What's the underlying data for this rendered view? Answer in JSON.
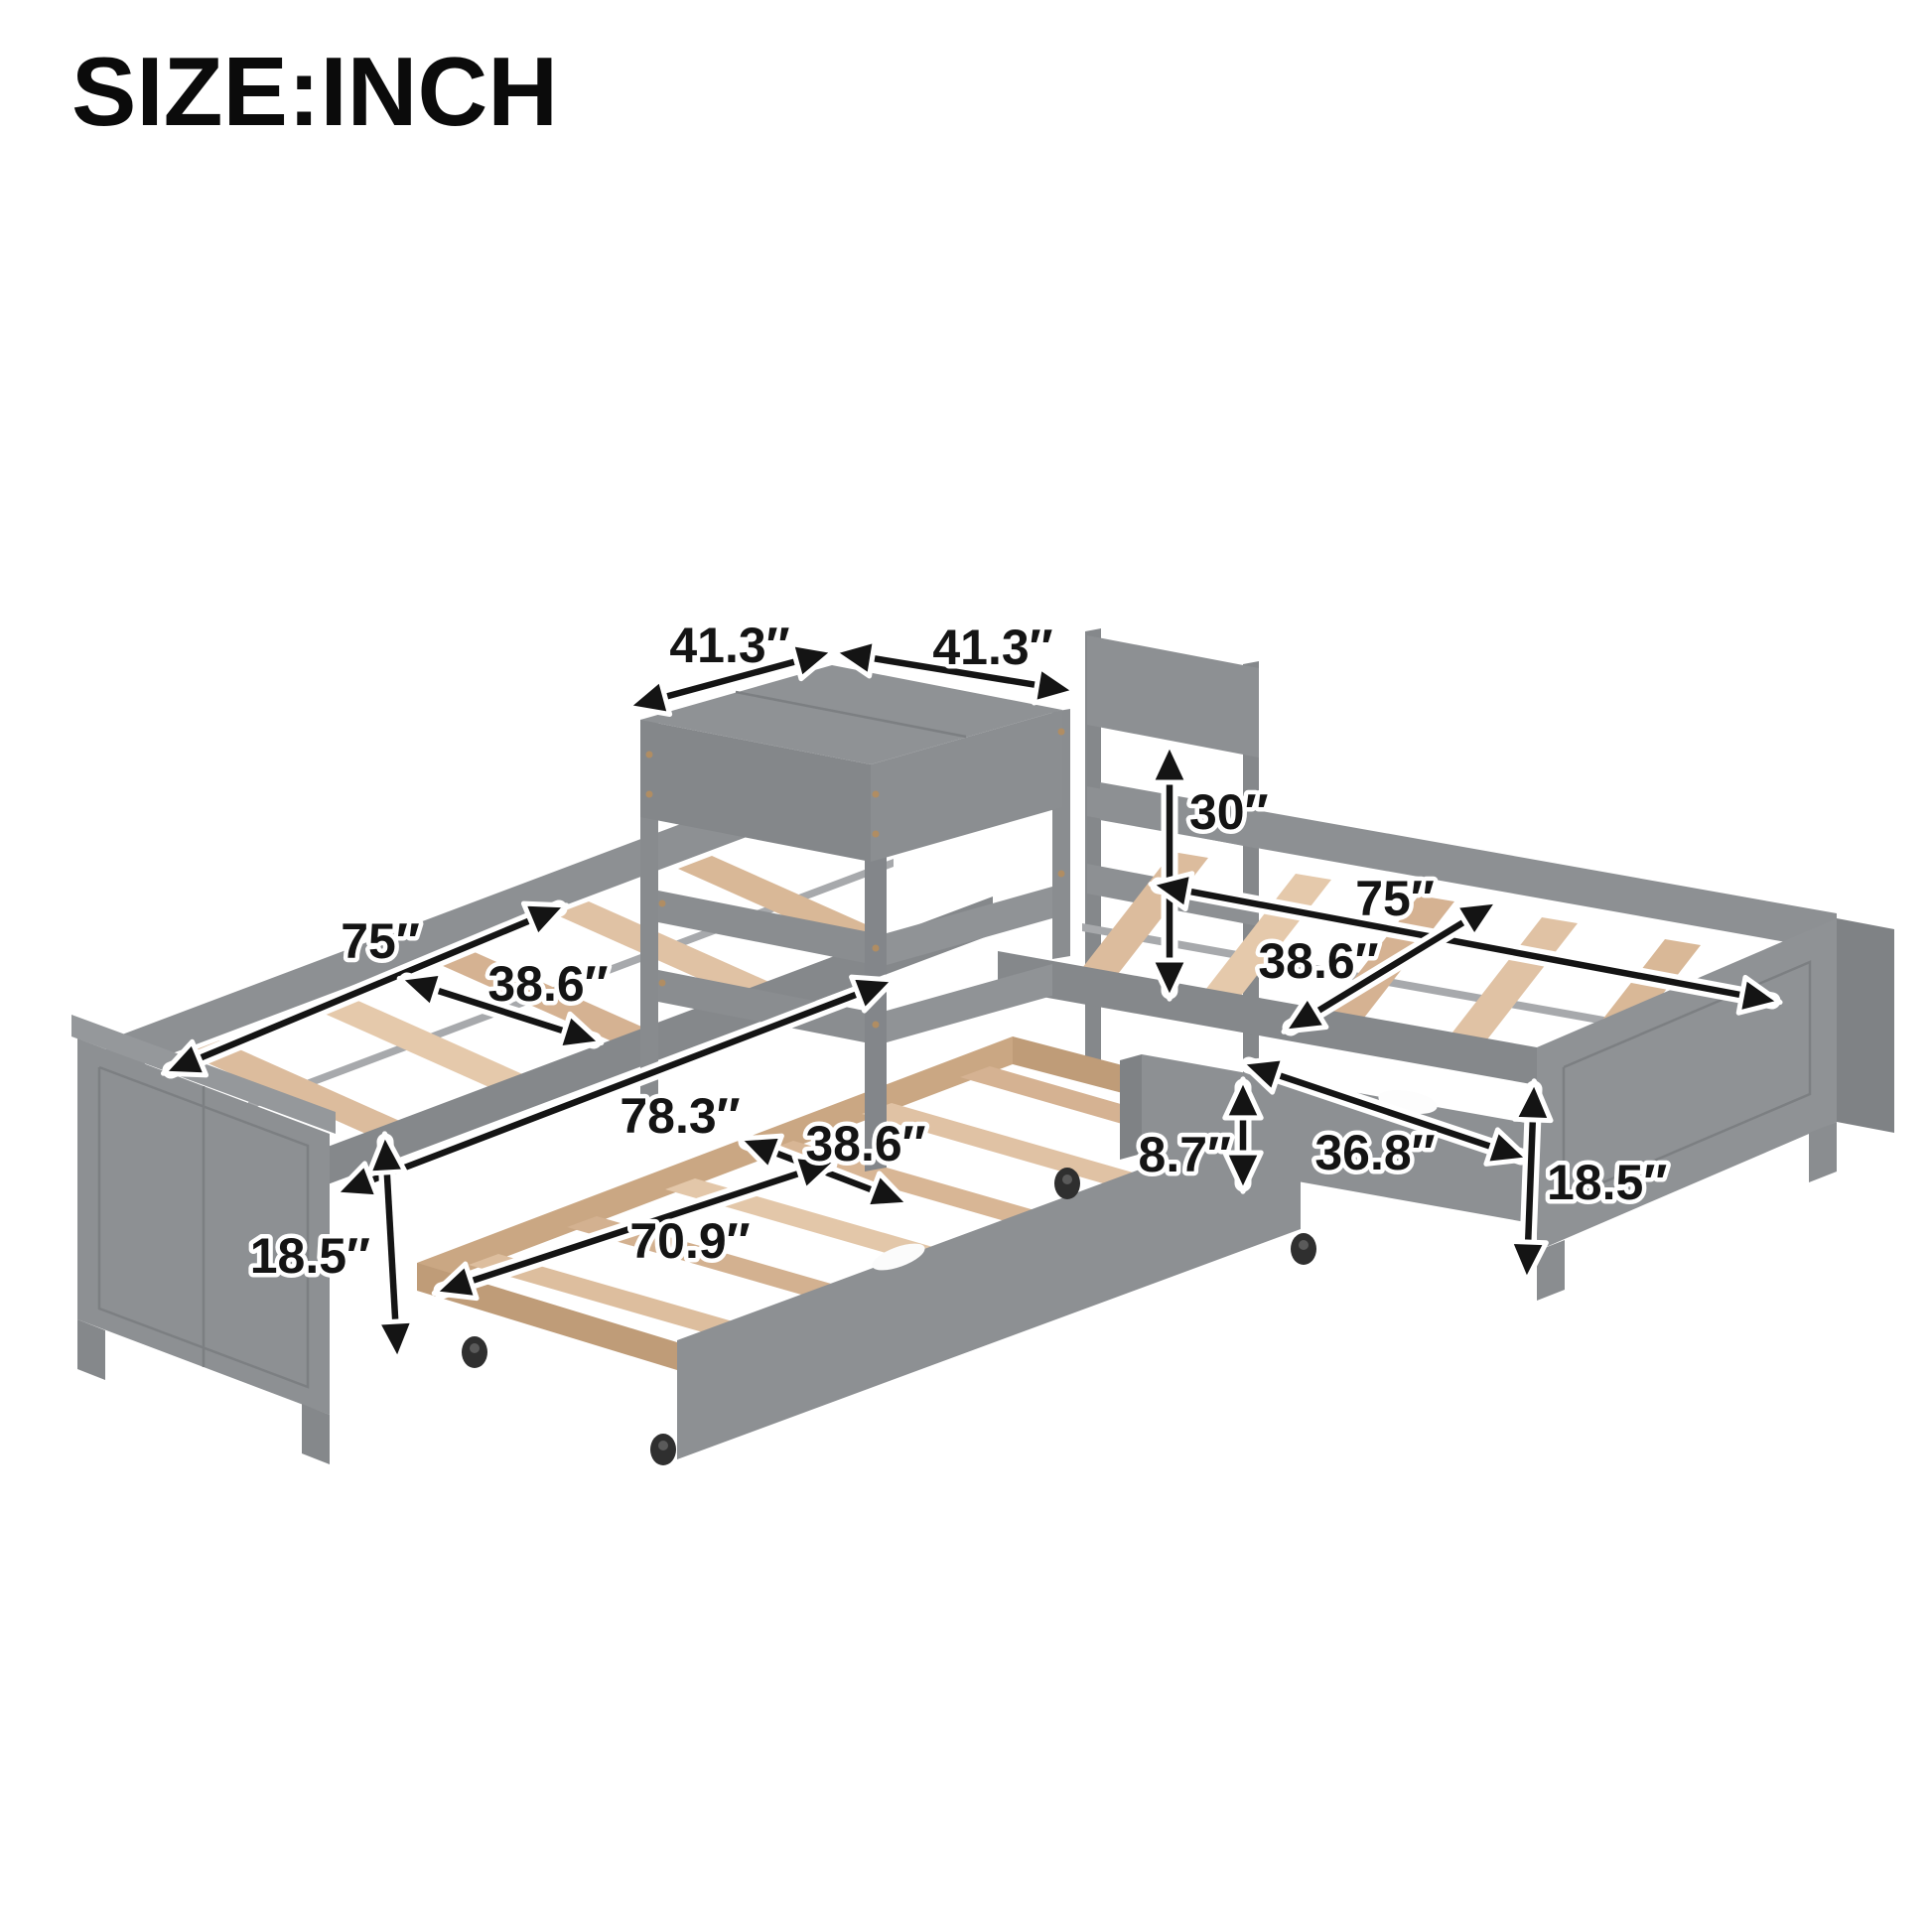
{
  "title": "SIZE:INCH",
  "diagram": {
    "dimensions": {
      "table_top_side_left": "41.3″",
      "table_top_side_right": "41.3″",
      "table_height": "30″",
      "left_bed_length": "75″",
      "left_bed_width": "38.6″",
      "right_bed_length": "75″",
      "right_bed_width": "38.6″",
      "overall_length_with_trundle": "78.3″",
      "trundle_width": "38.6″",
      "trundle_length": "70.9″",
      "trundle_height": "8.7″",
      "drawer_length": "36.8″",
      "left_footboard_height": "18.5″",
      "right_footboard_height": "18.5″"
    },
    "colors": {
      "frame_gray": "#8d9093",
      "frame_gray_dark": "#7f8285",
      "wood_slat": "#ddbe9e",
      "label_text": "#141414",
      "background": "#ffffff"
    }
  }
}
